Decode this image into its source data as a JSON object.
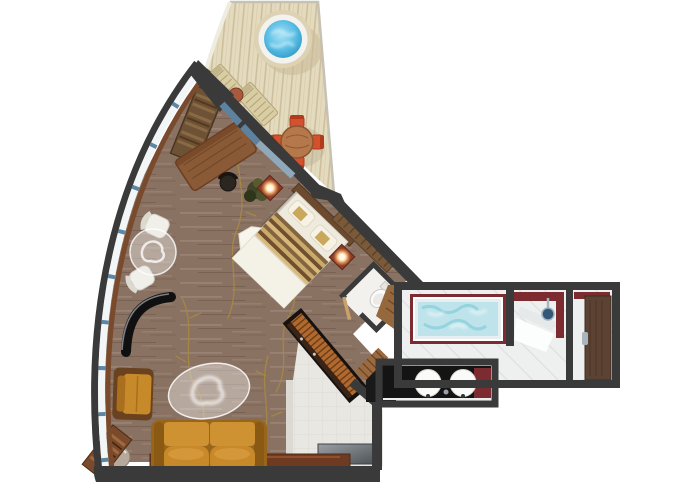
{
  "title": "suite-floor-plan",
  "colors": {
    "background": "#ffffff",
    "wall": "#3a3a3a",
    "hull_glass": "#f3f6f7",
    "window_blue": "#5c86a3",
    "sill_wood": "#7a4a2d",
    "deck": "#e4dabd",
    "deck_stripe": "#cdbf9e",
    "hot_tub_water": "#45b1dd",
    "hot_tub_rim": "#f4f2ec",
    "lounger": "#d9cda4",
    "lounger_slat": "#b2a377",
    "carpet": "#8a7263",
    "carpet_vine": "#a8893f",
    "sliding_door_glass": "#5d82a0",
    "bed_linen": "#efeade",
    "bed_runner_dark": "#83643c",
    "bed_runner_light": "#caa96a",
    "headboard": "#6b4a30",
    "nightstand": "#8c3b26",
    "lamp_glow": "#ffd9a0",
    "desk_wood": "#8a5a36",
    "closet_wood": "#6e5236",
    "chair_white": "#f1efe9",
    "glass_table": "rgba(238,236,230,0.45)",
    "tv_black": "#101010",
    "armchair": "#c78a2b",
    "armchair_frame": "#6b421f",
    "sofa": "#c8892a",
    "sofa_frame": "#99651b",
    "console_wood": "#6e3a22",
    "media_console_wood": "#b06a30",
    "entry_floor": "#e9e7e1",
    "bath_floor": "#eef0ef",
    "bath_wall_red": "#7c2b31",
    "tub_water": "#bfe3eb",
    "shower_head": "#335877",
    "door_wood": "#5b4233",
    "counter_black": "#141414",
    "sink_white": "#fafaf8",
    "chrome": "#aab6bd",
    "dining_table_wood": "#b5784a",
    "dining_chair": "#d5502c",
    "side_table": "#b7a99b",
    "wc_floor": "#f2f1ee",
    "toilet_white": "#fbfbf9",
    "plant_green": "#3f4526",
    "wood_shelf": "#7a4a2c"
  },
  "areas": [
    {
      "name": "balcony",
      "features": [
        "hot-tub",
        "lounge-chair",
        "lounge-chair",
        "patio-side-table",
        "dining-table",
        "dining-chairs",
        "deck-planks",
        "railing"
      ]
    },
    {
      "name": "living-bedroom",
      "features": [
        "curved-hull-windows",
        "wardrobe",
        "desk",
        "desk-chair",
        "sliding-glass-door",
        "plant",
        "king-bed",
        "nightstand-lamps",
        "wall-wardrobe",
        "white-armchairs",
        "round-glass-table",
        "curved-tv",
        "armchair",
        "oval-coffee-table",
        "sofa",
        "side-table",
        "corner-shelf",
        "console-shelf",
        "media-console",
        "carpet-vine-pattern"
      ]
    },
    {
      "name": "entry-hall",
      "features": [
        "tile-floor",
        "entry-console"
      ]
    },
    {
      "name": "wc",
      "features": [
        "toilet",
        "door"
      ]
    },
    {
      "name": "bathroom",
      "features": [
        "jetted-tub",
        "shower",
        "shower-head",
        "double-sinks",
        "vanity-counter",
        "entrance-door",
        "wood-mat"
      ]
    }
  ]
}
